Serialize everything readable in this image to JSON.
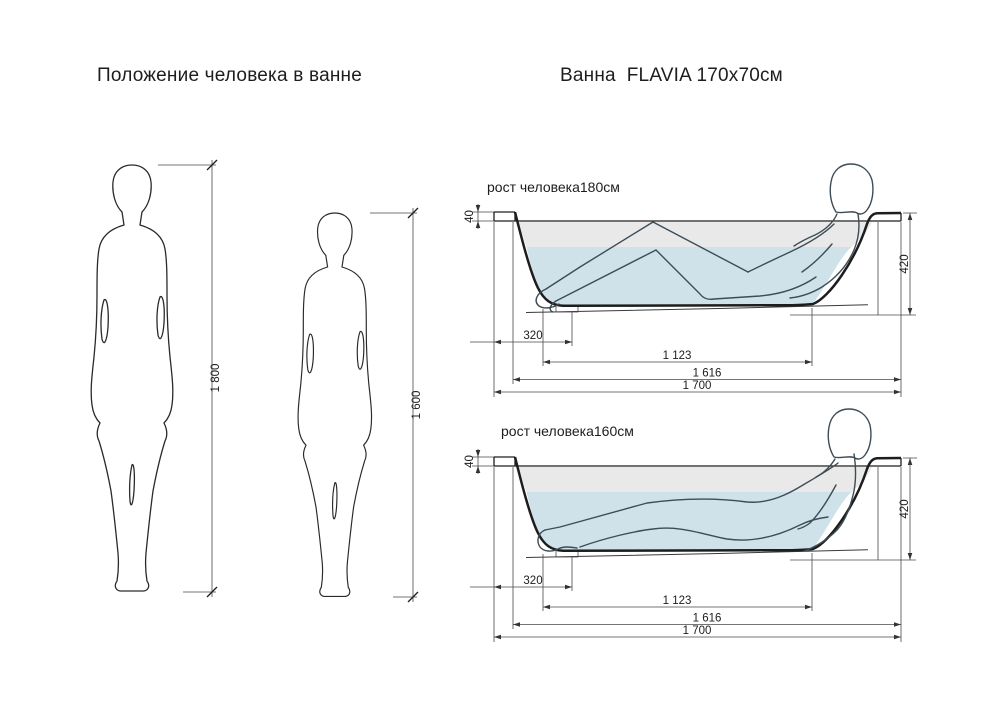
{
  "titles": {
    "left": "Положение человека в ванне",
    "right": "Ванна  FLAVIA 170x70см"
  },
  "left_panel": {
    "figures": [
      {
        "height_label": "1 800"
      },
      {
        "height_label": "1 600"
      }
    ]
  },
  "tubs": [
    {
      "caption": "рост человека180см",
      "pose": "knees-bent",
      "dims": {
        "rim_height": "40",
        "depth": "420",
        "drain_offset": "320",
        "bottom_length": "1 123",
        "top_inner_length": "1 616",
        "overall_length": "1 700"
      }
    },
    {
      "caption": "рост человека160см",
      "pose": "legs-extended",
      "dims": {
        "rim_height": "40",
        "depth": "420",
        "drain_offset": "320",
        "bottom_length": "1 123",
        "top_inner_length": "1 616",
        "overall_length": "1 700"
      }
    }
  ],
  "colors": {
    "water": "#cfe2ea",
    "headroom": "#e9e9e9",
    "outline": "#1d1d1d",
    "person": "#3d4c56",
    "dimension": "#333333"
  }
}
